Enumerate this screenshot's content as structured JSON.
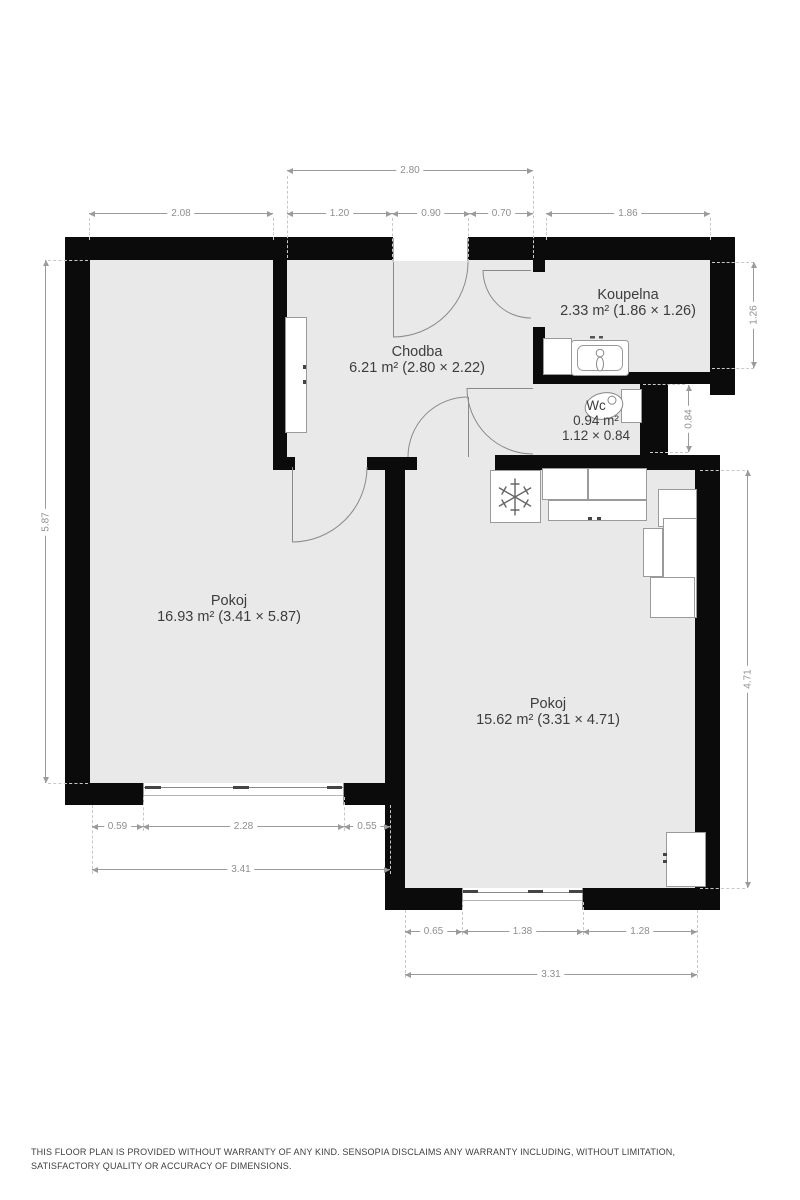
{
  "title": "Floor plan",
  "rooms": {
    "koupelna": {
      "name": "Koupelna",
      "area": "2.33 m² (1.86 × 1.26)"
    },
    "wc": {
      "name": "Wc",
      "area": "0.94 m²",
      "size": "1.12 × 0.84"
    },
    "chodba": {
      "name": "Chodba",
      "area": "6.21 m² (2.80 × 2.22)"
    },
    "pokoj_left": {
      "name": "Pokoj",
      "area": "16.93 m² (3.41 × 5.87)"
    },
    "pokoj_right": {
      "name": "Pokoj",
      "area": "15.62 m² (3.31 × 4.71)"
    }
  },
  "dims": {
    "d280": "2.80",
    "d208": "2.08",
    "d120": "1.20",
    "d090": "0.90",
    "d070": "0.70",
    "d186": "1.86",
    "d587": "5.87",
    "d126": "1.26",
    "d084": "0.84",
    "d471": "4.71",
    "d059": "0.59",
    "d228": "2.28",
    "d055": "0.55",
    "d341": "3.41",
    "d065": "0.65",
    "d138": "1.38",
    "d128": "1.28",
    "d331": "3.31"
  },
  "icons": {
    "freezer": "snowflake-icon",
    "sink": "sink-icon",
    "toilet": "toilet-icon"
  },
  "colors": {
    "wall": "#0b0b0b",
    "floor": "#e9e9e9",
    "dimension": "#9b9b9b",
    "label": "#3d3d3d"
  },
  "footer": {
    "disclaimer": "THIS FLOOR PLAN IS PROVIDED WITHOUT WARRANTY OF ANY KIND. SENSOPIA DISCLAIMS ANY WARRANTY INCLUDING, WITHOUT LIMITATION, SATISFACTORY QUALITY OR ACCURACY OF DIMENSIONS."
  }
}
